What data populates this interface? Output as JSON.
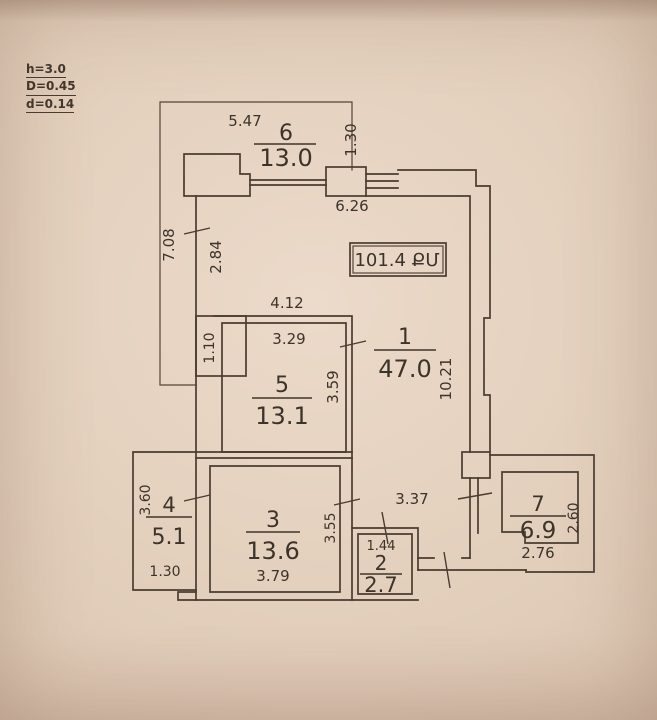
{
  "legend": {
    "h": "h=3.0",
    "D": "D=0.45",
    "d": "d=0.14"
  },
  "total": {
    "label": "101.4 ՔՄ"
  },
  "rooms": {
    "r1": {
      "number": "1",
      "area": "47.0"
    },
    "r2": {
      "number": "2",
      "area": "2.7"
    },
    "r3": {
      "number": "3",
      "area": "13.6"
    },
    "r4": {
      "number": "4",
      "area": "5.1"
    },
    "r5": {
      "number": "5",
      "area": "13.1"
    },
    "r6": {
      "number": "6",
      "area": "13.0"
    },
    "r7": {
      "number": "7",
      "area": "6.9"
    }
  },
  "dims": {
    "d547": "5.47",
    "d130a": "1.30",
    "d626": "6.26",
    "d708": "7.08",
    "d284": "2.84",
    "d110": "1.10",
    "d412": "4.12",
    "d329": "3.29",
    "d359": "3.59",
    "d1021": "10.21",
    "d360": "3.60",
    "d130b": "1.30",
    "d355": "3.55",
    "d379": "3.79",
    "d337": "3.37",
    "d144": "1.44",
    "d276": "2.76",
    "d260": "2.60"
  }
}
